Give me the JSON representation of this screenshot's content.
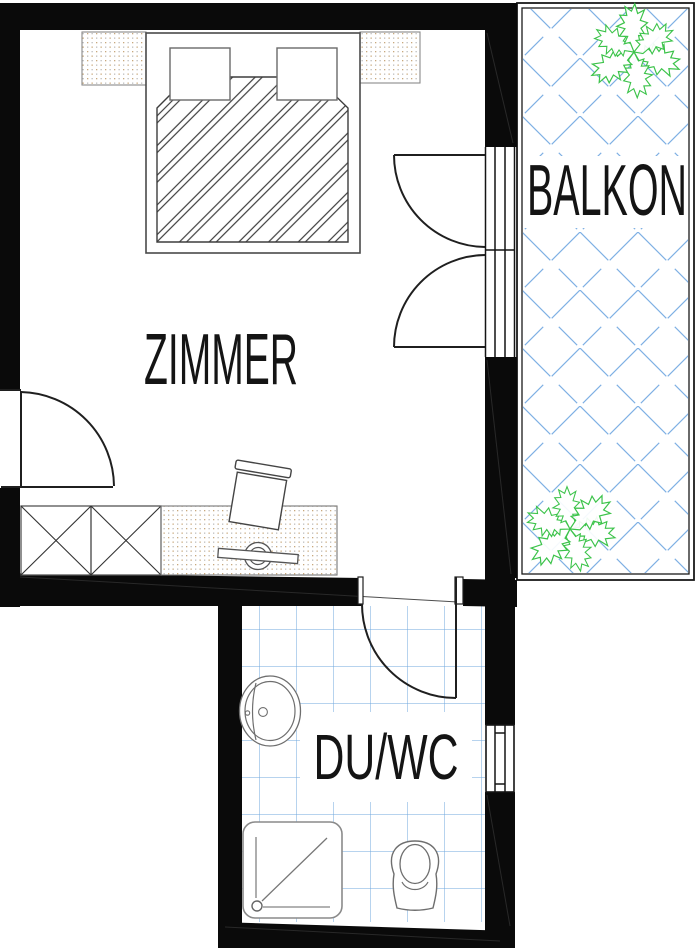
{
  "plan": {
    "rooms": [
      {
        "id": "zimmer",
        "label": "ZIMMER"
      },
      {
        "id": "balkon",
        "label": "BALKON"
      },
      {
        "id": "duwc",
        "label": "DU/WC"
      }
    ],
    "symbols": [
      "double-bed",
      "pillow",
      "nightstand",
      "wardrobe",
      "desk",
      "tv",
      "chair",
      "washbasin",
      "shower-tray",
      "toilet",
      "door-swing-icon",
      "french-door-icon",
      "window-icon",
      "plant-icon",
      "tile-grid",
      "balcony-crosshatch"
    ]
  },
  "colors": {
    "paper": "#ffffff",
    "wall": "#0a0a0a",
    "line": "#4a4a4a",
    "fixture": "#6e6e6e",
    "tile": "#6fa7de",
    "balcony_hatch": "#7fb0e4",
    "plant": "#3cc34a",
    "stipple_tan": "#c9a87c",
    "stipple_gray": "#bdbdbd"
  }
}
